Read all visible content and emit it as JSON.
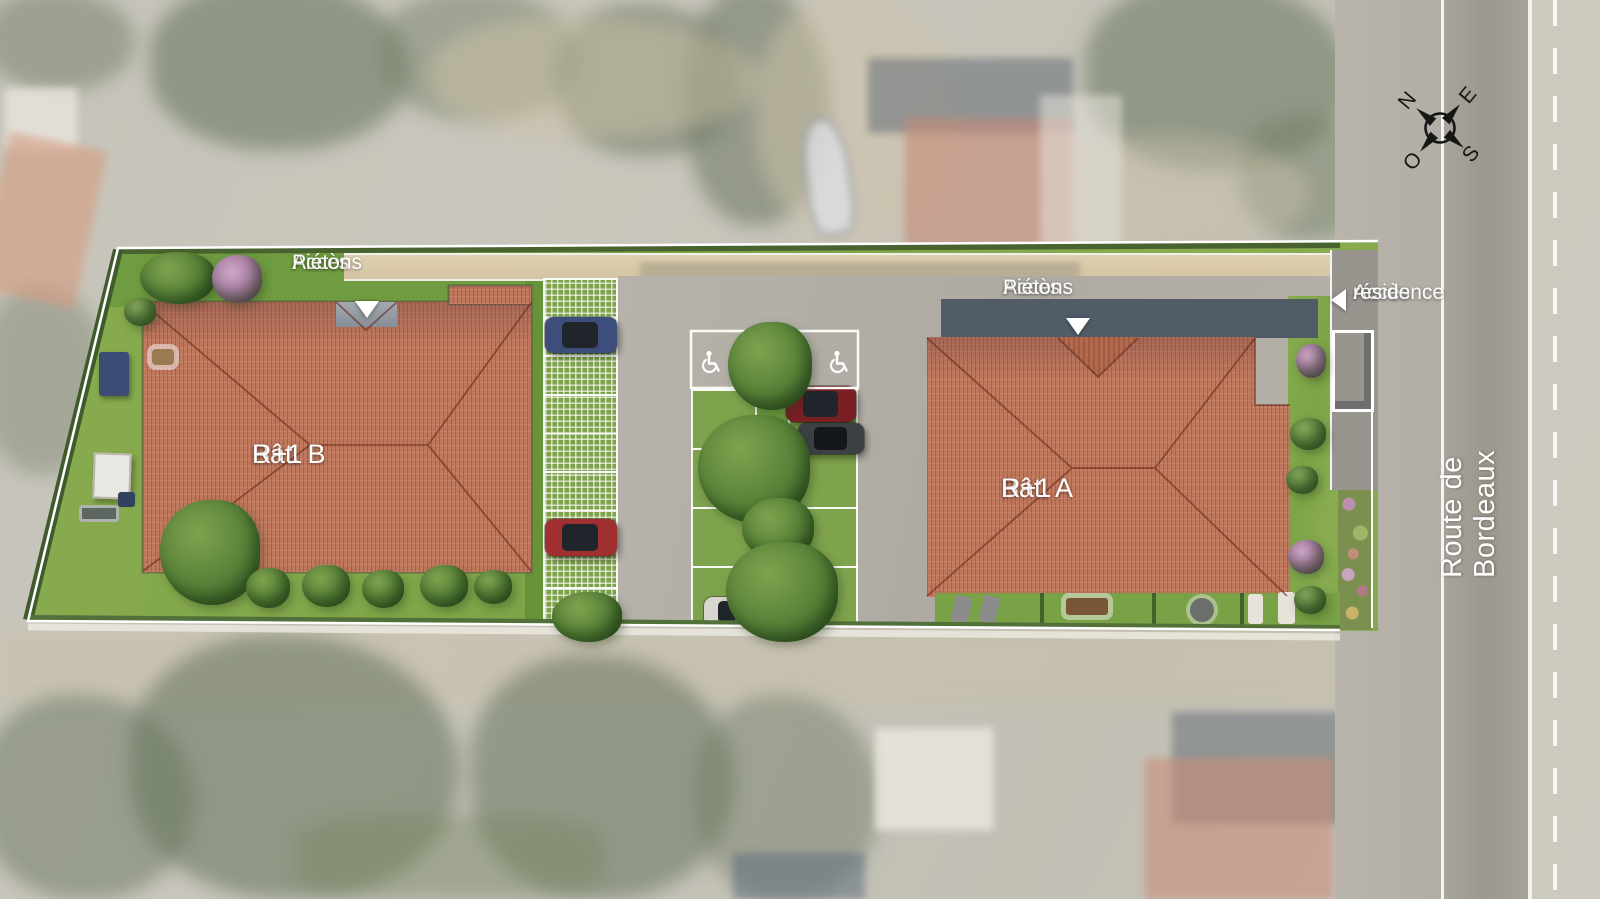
{
  "site_plan": {
    "title_context": "residence site plan over aerial photo",
    "buildings": [
      {
        "name": "Bât. B",
        "level": "R+1"
      },
      {
        "name": "Bât. A",
        "level": "R+1"
      }
    ],
    "access": {
      "pedestrian_b": {
        "line1": "Accès",
        "line2": "Piétons"
      },
      "pedestrian_a": {
        "line1": "Accès",
        "line2": "Piétons"
      },
      "residence": {
        "line1": "Accès",
        "line2": "résidence"
      }
    },
    "street": {
      "name": "Route de Bordeaux"
    },
    "compass": {
      "north": "N",
      "east": "E",
      "south": "S",
      "west": "O"
    },
    "parking": {
      "accessible_spaces": 2,
      "surface": "grass pavers"
    },
    "colors": {
      "roof": "#c0785d",
      "lawn": "#82a74b",
      "paver": "#7fa34d",
      "asphalt": "#b2aea6",
      "road": "#a5a19a",
      "hedge": "#3f5a2c",
      "shadow": "#4d5866",
      "label_text": "#ffffff",
      "path": "#d8c7a6"
    }
  }
}
